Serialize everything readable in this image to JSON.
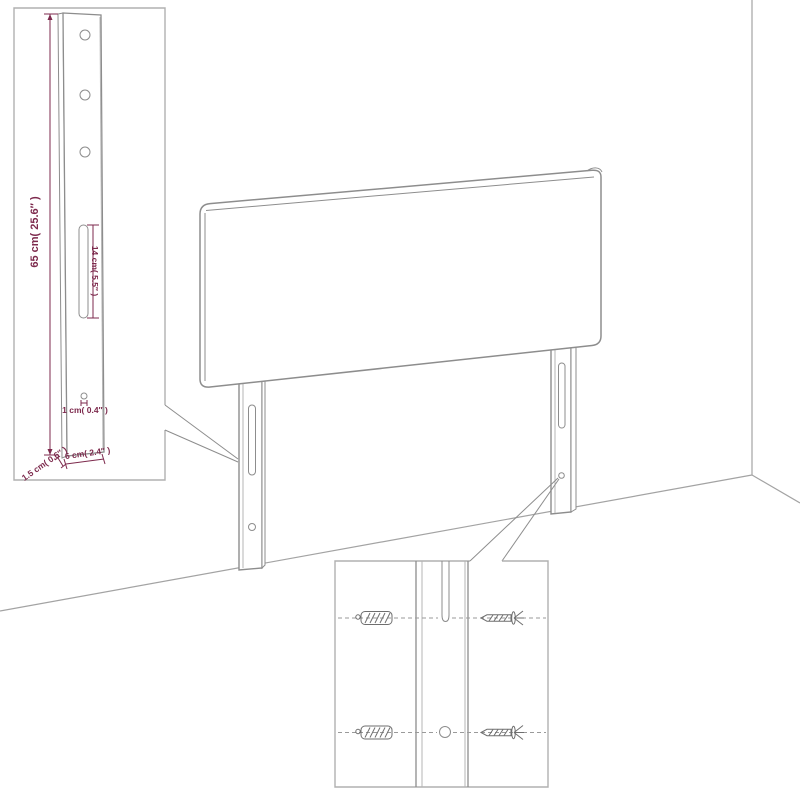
{
  "page": {
    "background": "#ffffff",
    "description": "Headboard with two legs shown in a room corner, with zoom insets for leg dimensions and wall-mounting hardware"
  },
  "colors": {
    "page_bg": "#ffffff",
    "dimension_text": "#7d2a4d",
    "drawing_line": "#8d8d8d",
    "wall_line": "#a3a3a3",
    "inset_border": "#b0b0b0",
    "hardware_line": "#6e6e6e",
    "dash_line": "#9a9a9a"
  },
  "leg_detail_inset": {
    "name": "leg-dimension-detail",
    "labels": {
      "height": "65 cm( 25.6″ )",
      "slot": "14 cm( 5.5″ )",
      "hole": "1 cm( 0.4″ )",
      "depth": "1.5 cm( 0.6″ )",
      "width": "6 cm( 2.4″ )"
    }
  },
  "mounting_inset": {
    "name": "wall-mounting-detail",
    "hardware": [
      {
        "icon": "wall-anchor-icon"
      },
      {
        "icon": "screw-icon"
      }
    ]
  }
}
